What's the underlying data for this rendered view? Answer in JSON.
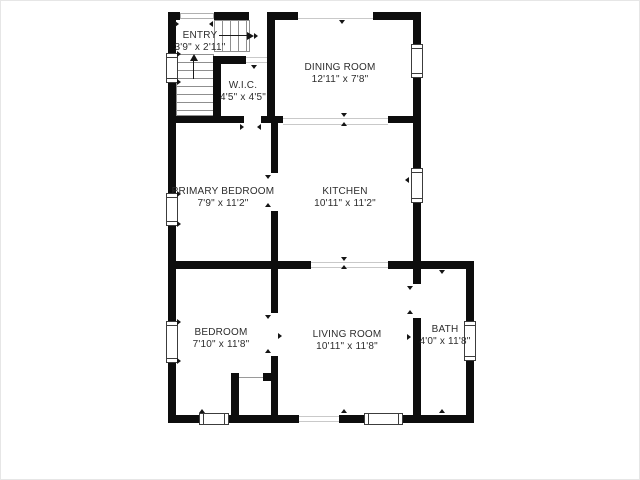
{
  "title": "Floor plan",
  "colors": {
    "wall": "#0d0d0d",
    "text": "#2d2d2d",
    "background": "#ffffff",
    "opening_line": "#c9c9c9"
  },
  "rooms": {
    "entry": {
      "name": "ENTRY",
      "dims": "3'9\" x 2'11\""
    },
    "wic": {
      "name": "W.I.C.",
      "dims": "4'5\" x 4'5\""
    },
    "dining": {
      "name": "DINING ROOM",
      "dims": "12'11\" x 7'8\""
    },
    "primary": {
      "name": "PRIMARY BEDROOM",
      "dims": "7'9\" x 11'2\""
    },
    "kitchen": {
      "name": "KITCHEN",
      "dims": "10'11\" x 11'2\""
    },
    "bedroom": {
      "name": "BEDROOM",
      "dims": "7'10\" x 11'8\""
    },
    "living": {
      "name": "LIVING ROOM",
      "dims": "10'11\" x 11'8\""
    },
    "bath": {
      "name": "BATH",
      "dims": "4'0\" x 11'8\""
    }
  }
}
